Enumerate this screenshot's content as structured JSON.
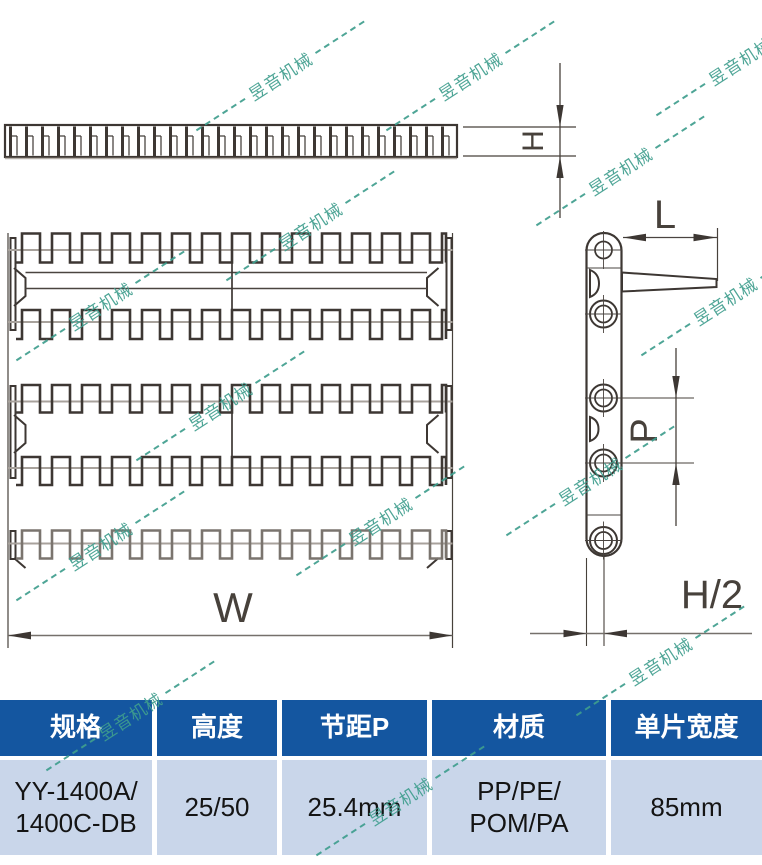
{
  "watermark": {
    "text": "昱音机械",
    "color": "#3f9e8e"
  },
  "drawing": {
    "labels": {
      "belt_height": "H",
      "flight_length": "L",
      "pitch": "P",
      "module_width": "W",
      "half_height": "H/2"
    }
  },
  "table": {
    "headers": [
      "规格",
      "高度",
      "节距P",
      "材质",
      "单片宽度"
    ],
    "row": {
      "spec": "YY-1400A/\n1400C-DB",
      "height": "25/50",
      "pitch": "25.4mm",
      "material": "PP/PE/\nPOM/PA",
      "width": "85mm"
    }
  },
  "colors": {
    "header_bg": "#1456a0",
    "row_bg": "#c9d6ea",
    "line_dark": "#3d3733",
    "line_gray": "#a8a29c",
    "watermark": "#3f9e8e"
  }
}
